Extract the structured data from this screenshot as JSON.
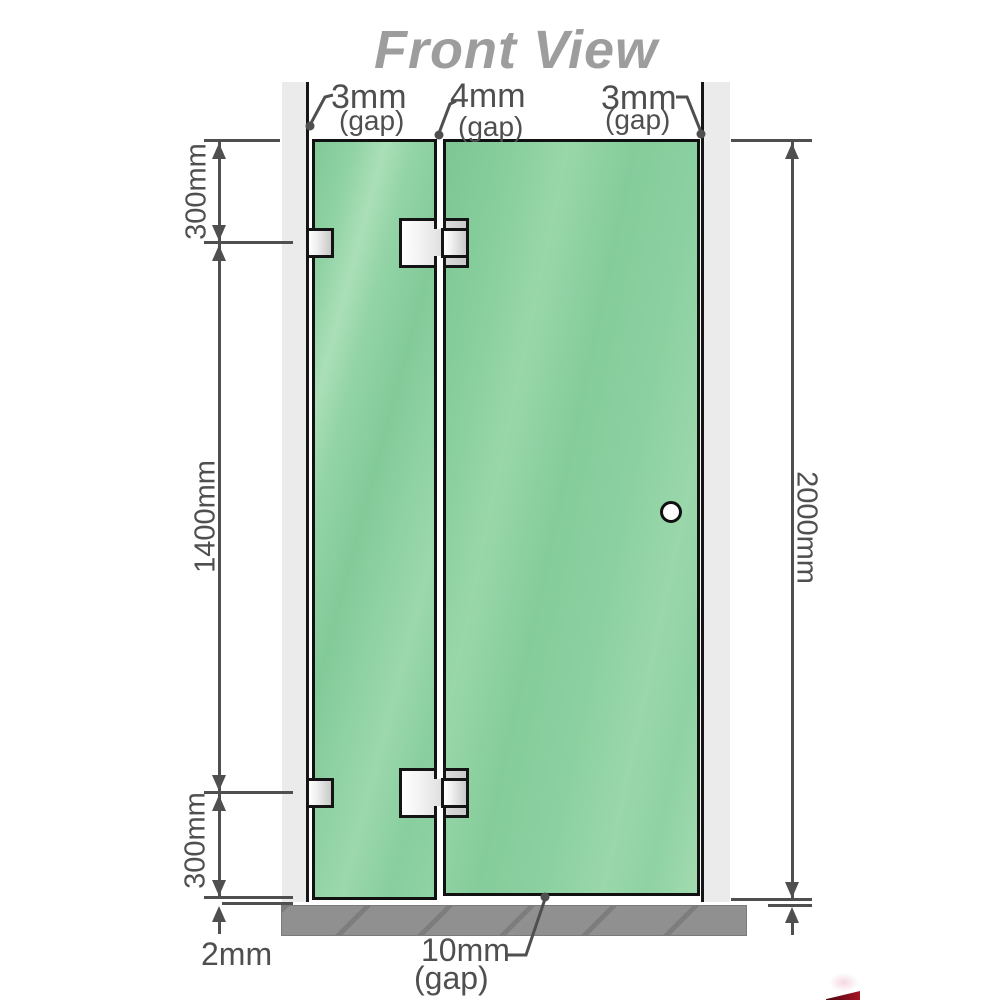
{
  "title": "Front View",
  "labels": {
    "gap_top_left": "3mm",
    "gap_top_left_sub": "(gap)",
    "gap_top_middle": "4mm",
    "gap_top_middle_sub": "(gap)",
    "gap_top_right": "3mm",
    "gap_top_right_sub": "(gap)",
    "dim_left_top": "300mm",
    "dim_left_middle": "1400mm",
    "dim_left_bottom": "300mm",
    "dim_right_height": "2000mm",
    "dim_bottom_floor": "2mm",
    "gap_bottom": "10mm",
    "gap_bottom_sub": "(gap)"
  },
  "colors": {
    "glass_green": "#8ed2a3",
    "glass_highlight": "#abdfb7",
    "wall_gray": "#ebebeb",
    "base_gray": "#909090",
    "dimension_line_gray": "#4f4f4f",
    "title_gray": "#9d9d9d",
    "outline_black": "#141414",
    "hardware_silver": "#c9c9c9",
    "corner_mark_red": "#a61326"
  }
}
